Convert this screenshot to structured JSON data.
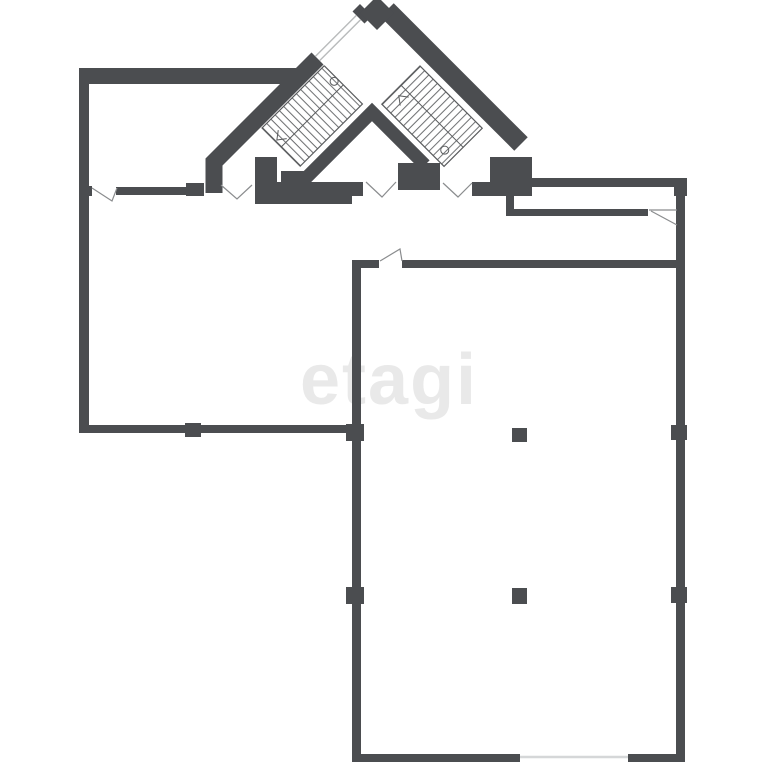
{
  "watermark": {
    "text": "etagi"
  },
  "colors": {
    "wall": "#4b4d50",
    "stair": "#5a5c5e",
    "door": "#8a8c8e",
    "window": "#d5d7d8",
    "mark": "#e9e9e9",
    "bg": "#ffffff"
  },
  "plan": {
    "type": "architectural floor plan",
    "staircase_count": 2,
    "free_column_count": 2,
    "wall_pier_count": 5,
    "door_opening_count": 6,
    "window_count": 2
  }
}
